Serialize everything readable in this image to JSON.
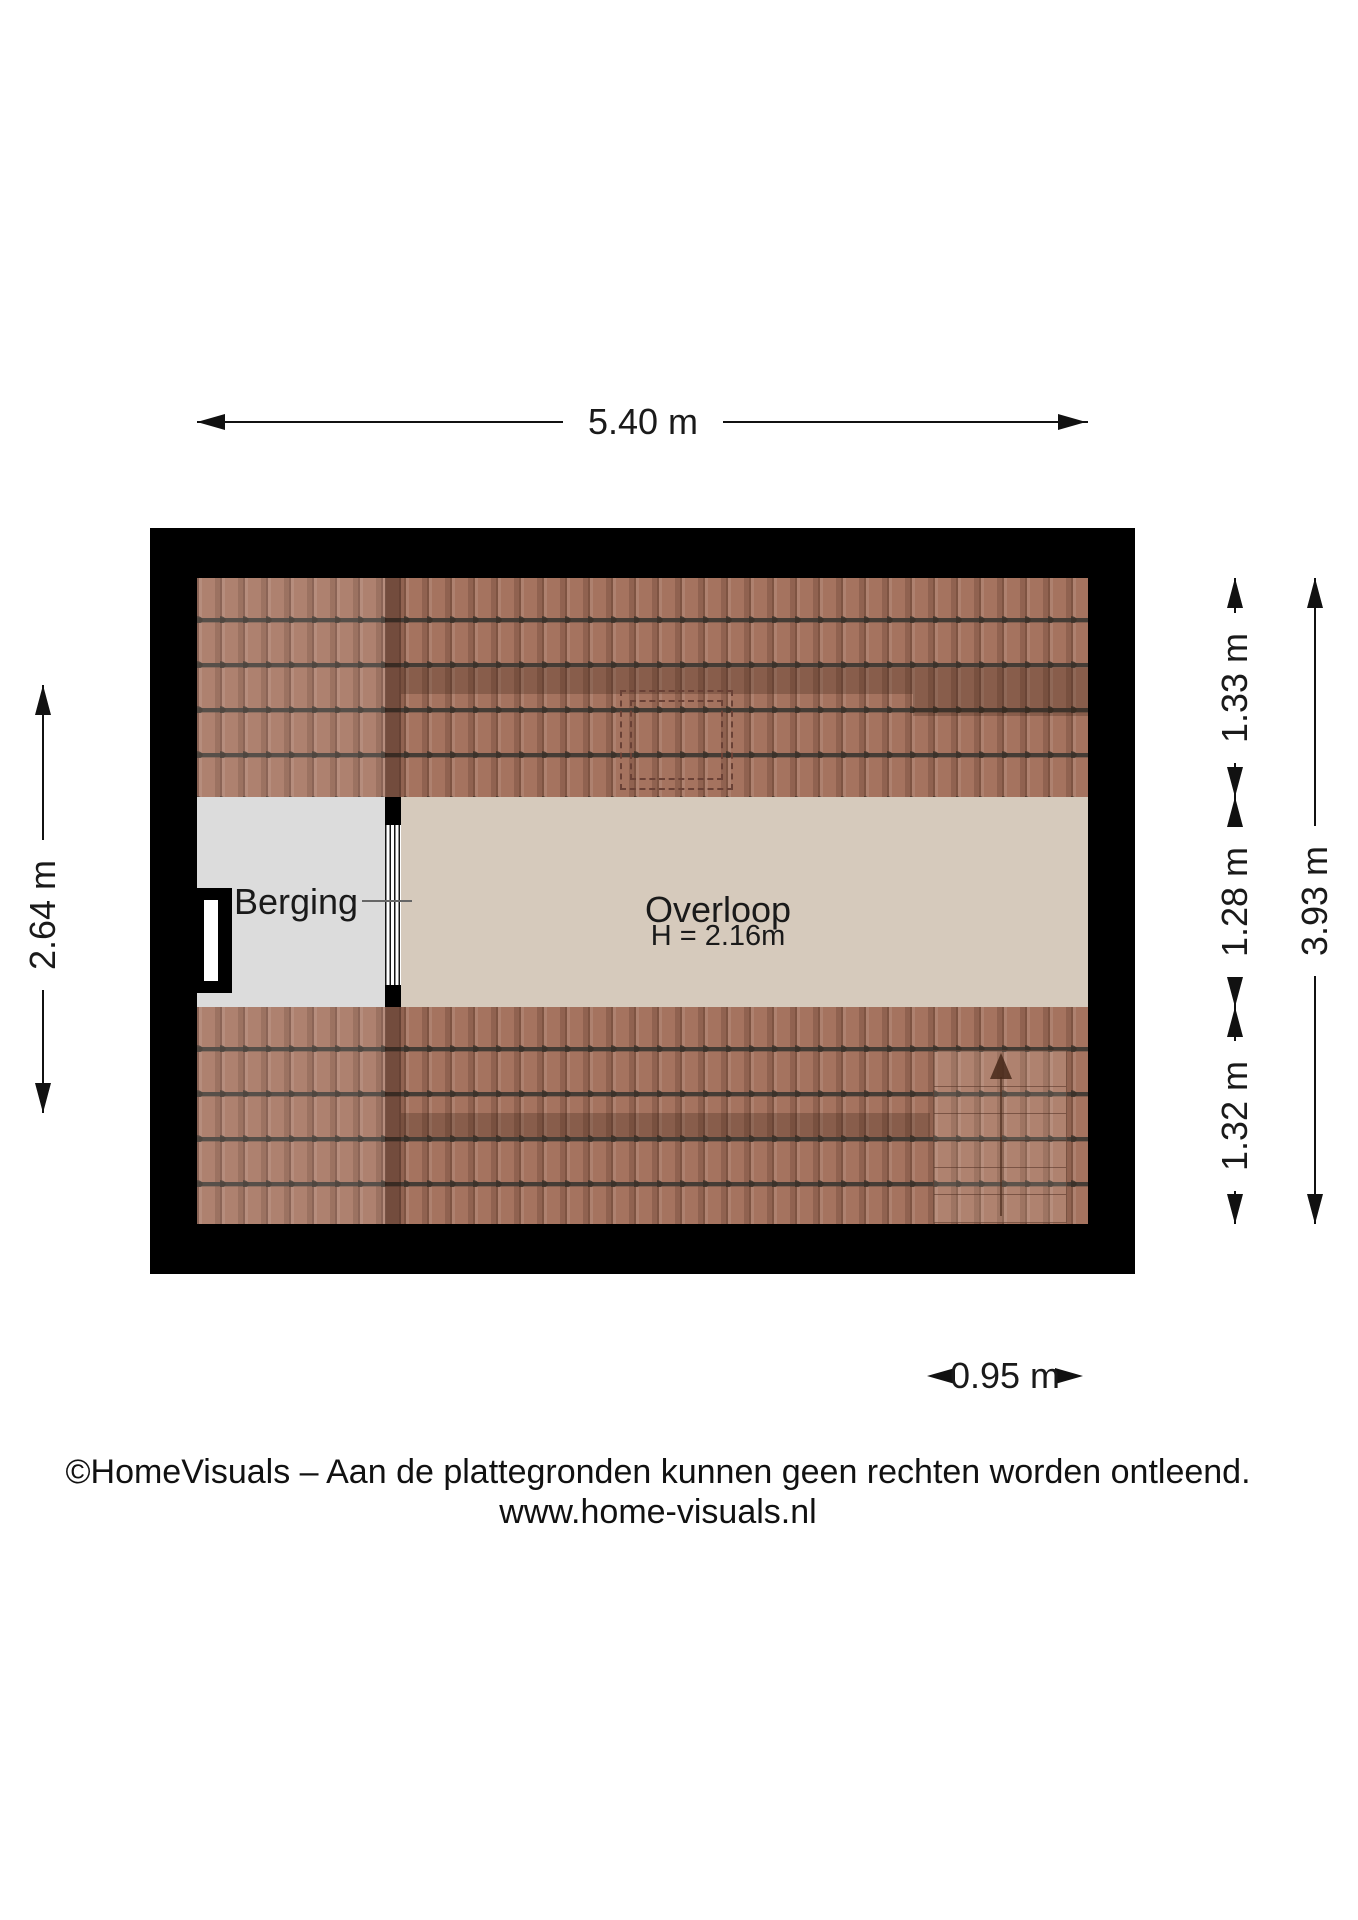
{
  "diagram": {
    "type": "floor-plan",
    "provider": "HomeVisuals"
  },
  "rooms": {
    "berging": {
      "name": "Berging"
    },
    "overloop": {
      "name": "Overloop",
      "height": "H = 2.16m"
    }
  },
  "dimensions": {
    "top": {
      "label": "5.40 m"
    },
    "left": {
      "label": "2.64 m"
    },
    "right_inner": {
      "segments": [
        {
          "label": "1.33 m"
        },
        {
          "label": "1.28 m"
        },
        {
          "label": "1.32 m"
        }
      ]
    },
    "right_outer": {
      "label": "3.93 m"
    },
    "bottom": {
      "label": "0.95 m"
    }
  },
  "footer": {
    "disclaimer": "©HomeVisuals – Aan de plattegronden kunnen geen rechten worden ontleend.",
    "website": "www.home-visuals.nl"
  },
  "colors": {
    "background": "#ffffff",
    "wall": "#000000",
    "roof_tile": "#a5735f",
    "roof_shadow": "rgba(48,24,14,0.24)",
    "berging_floor": "#dcdcdc",
    "overloop_floor": "#d6cabc",
    "text": "#1a1a1a",
    "skylight_dash": "#6a4136"
  }
}
